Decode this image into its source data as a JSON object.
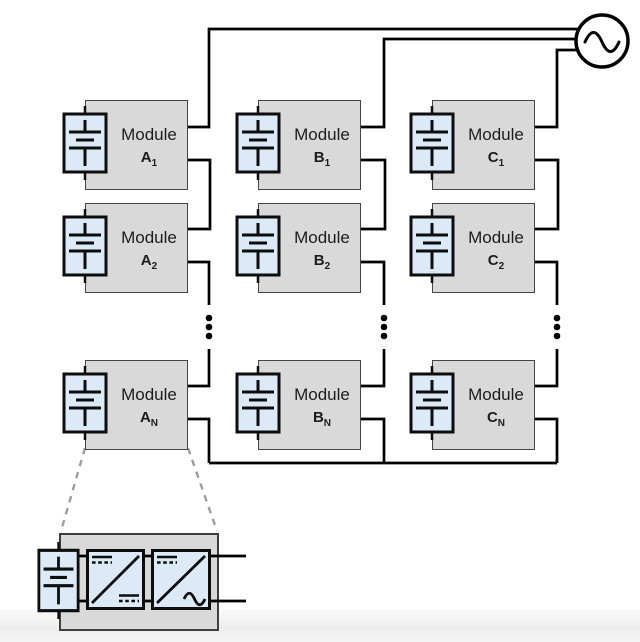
{
  "modules": [
    {
      "word": "Module",
      "letter": "A",
      "sub": "1"
    },
    {
      "word": "Module",
      "letter": "A",
      "sub": "2"
    },
    {
      "word": "Module",
      "letter": "A",
      "sub": "N"
    },
    {
      "word": "Module",
      "letter": "B",
      "sub": "1"
    },
    {
      "word": "Module",
      "letter": "B",
      "sub": "2"
    },
    {
      "word": "Module",
      "letter": "B",
      "sub": "N"
    },
    {
      "word": "Module",
      "letter": "C",
      "sub": "1"
    },
    {
      "word": "Module",
      "letter": "C",
      "sub": "2"
    },
    {
      "word": "Module",
      "letter": "C",
      "sub": "N"
    }
  ],
  "icons": {
    "ac_source": "ac-source-icon",
    "battery": "battery-icon",
    "dc_dc_converter": "dc-dc-converter-icon",
    "dc_ac_inverter": "dc-ac-inverter-icon",
    "ellipsis": "vertical-ellipsis"
  },
  "colors": {
    "module_fill": "#d9d9d9",
    "module_border": "#454545",
    "battery_fill": "#dce9f6",
    "wire": "#000000",
    "callout": "#9d9d9d",
    "text": "#1c1c1c",
    "footer": "#ededed",
    "bg": "#ffffff"
  }
}
